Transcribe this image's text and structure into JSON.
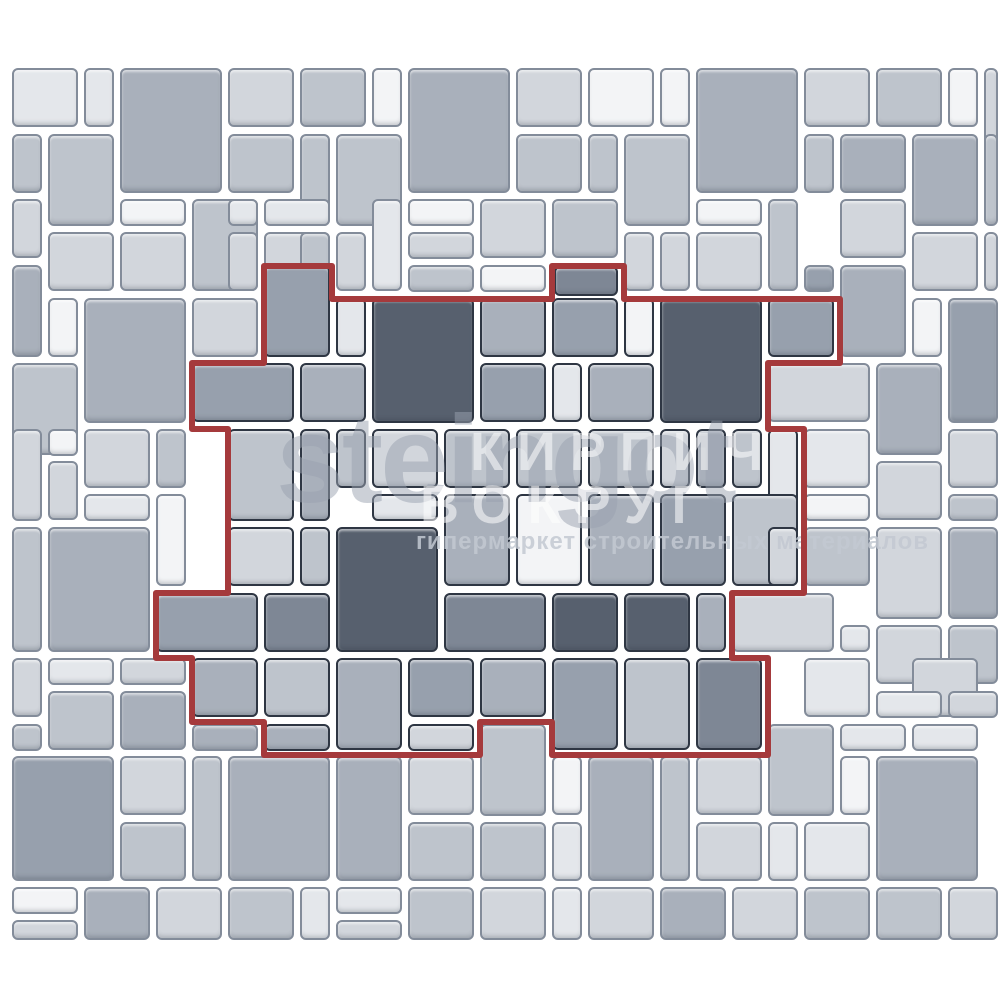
{
  "canvas": {
    "width": 1000,
    "height": 1000,
    "background": "#ffffff"
  },
  "palette": [
    "#f3f4f6",
    "#e4e7eb",
    "#d2d6dc",
    "#bec4cc",
    "#a9b0bb",
    "#97a0ad",
    "#7e8795",
    "#57606e"
  ],
  "strokes": {
    "outside_border": "#838c9a",
    "inside_border": "#2e3643",
    "grout": "#ffffff"
  },
  "outline": {
    "color": "#a53a3c",
    "width": 6,
    "path": "M 264 266 L 332 266 L 332 299 L 552 299 L 552 266 L 624 266 L 624 299 L 840 299 L 840 363 L 768 363 L 768 429 L 804 429 L 804 593 L 732 593 L 732 658 L 768 658 L 768 755 L 552 755 L 552 722 L 480 722 L 480 755 L 264 755 L 264 722 L 192 722 L 192 658 L 156 658 L 156 593 L 228 593 L 228 429 L 192 429 L 192 363 L 264 363 Z"
  },
  "watermark": {
    "brand": "steingot",
    "brand_color": "#9aa2b0",
    "tagline": "гипермаркет строительных материалов",
    "tagline_color": "#c3c9d2",
    "overlay_line1": "КИРПИЧ",
    "overlay_line2": "ВОКРУГ",
    "overlay_color": "#ffffff"
  },
  "tiles": [
    [
      12,
      68,
      66,
      59,
      1,
      0
    ],
    [
      84,
      68,
      30,
      59,
      1,
      0
    ],
    [
      120,
      68,
      102,
      125,
      4,
      0
    ],
    [
      228,
      68,
      66,
      59,
      2,
      0
    ],
    [
      300,
      68,
      66,
      59,
      3,
      0
    ],
    [
      372,
      68,
      30,
      59,
      0,
      0
    ],
    [
      408,
      68,
      102,
      125,
      4,
      0
    ],
    [
      516,
      68,
      66,
      59,
      2,
      0
    ],
    [
      588,
      68,
      66,
      59,
      0,
      0
    ],
    [
      660,
      68,
      30,
      59,
      0,
      0
    ],
    [
      696,
      68,
      102,
      125,
      4,
      0
    ],
    [
      804,
      68,
      66,
      59,
      2,
      0
    ],
    [
      876,
      68,
      66,
      59,
      3,
      0
    ],
    [
      948,
      68,
      30,
      59,
      0,
      0
    ],
    [
      984,
      68,
      14,
      125,
      2,
      0
    ],
    [
      12,
      134,
      30,
      59,
      3,
      0
    ],
    [
      48,
      134,
      66,
      92,
      3,
      0
    ],
    [
      228,
      134,
      66,
      59,
      3,
      0
    ],
    [
      300,
      134,
      30,
      92,
      3,
      0
    ],
    [
      336,
      134,
      66,
      92,
      3,
      0
    ],
    [
      516,
      134,
      66,
      59,
      3,
      0
    ],
    [
      588,
      134,
      30,
      59,
      3,
      0
    ],
    [
      624,
      134,
      66,
      92,
      3,
      0
    ],
    [
      804,
      134,
      30,
      59,
      3,
      0
    ],
    [
      840,
      134,
      66,
      59,
      4,
      0
    ],
    [
      912,
      134,
      66,
      92,
      4,
      0
    ],
    [
      984,
      134,
      14,
      92,
      3,
      0
    ],
    [
      12,
      199,
      30,
      59,
      2,
      0
    ],
    [
      120,
      199,
      66,
      27,
      0,
      0
    ],
    [
      192,
      199,
      66,
      92,
      3,
      0
    ],
    [
      228,
      199,
      30,
      27,
      1,
      0
    ],
    [
      264,
      199,
      66,
      27,
      1,
      0
    ],
    [
      372,
      199,
      30,
      92,
      1,
      0
    ],
    [
      408,
      199,
      66,
      27,
      0,
      0
    ],
    [
      480,
      199,
      66,
      59,
      2,
      0
    ],
    [
      552,
      199,
      66,
      59,
      3,
      0
    ],
    [
      696,
      199,
      66,
      27,
      0,
      0
    ],
    [
      768,
      199,
      30,
      92,
      3,
      0
    ],
    [
      840,
      199,
      66,
      59,
      2,
      0
    ],
    [
      48,
      232,
      66,
      59,
      2,
      0
    ],
    [
      120,
      232,
      66,
      59,
      2,
      0
    ],
    [
      228,
      232,
      30,
      59,
      2,
      0
    ],
    [
      264,
      232,
      66,
      59,
      2,
      0
    ],
    [
      300,
      232,
      30,
      59,
      3,
      0
    ],
    [
      336,
      232,
      30,
      59,
      2,
      0
    ],
    [
      408,
      232,
      66,
      27,
      2,
      0
    ],
    [
      624,
      232,
      30,
      59,
      2,
      0
    ],
    [
      660,
      232,
      30,
      59,
      2,
      0
    ],
    [
      696,
      232,
      66,
      59,
      2,
      0
    ],
    [
      912,
      232,
      66,
      59,
      2,
      0
    ],
    [
      984,
      232,
      14,
      59,
      2,
      0
    ],
    [
      12,
      265,
      30,
      92,
      4,
      0
    ],
    [
      408,
      265,
      66,
      27,
      3,
      0
    ],
    [
      480,
      265,
      66,
      27,
      0,
      0
    ],
    [
      804,
      265,
      30,
      27,
      5,
      0
    ],
    [
      840,
      265,
      66,
      92,
      4,
      0
    ],
    [
      48,
      298,
      30,
      59,
      0,
      0
    ],
    [
      84,
      298,
      102,
      125,
      4,
      0
    ],
    [
      192,
      298,
      66,
      59,
      2,
      0
    ],
    [
      912,
      298,
      30,
      59,
      0,
      0
    ],
    [
      948,
      298,
      50,
      125,
      5,
      0
    ],
    [
      12,
      363,
      66,
      92,
      3,
      0
    ],
    [
      768,
      363,
      102,
      59,
      2,
      0
    ],
    [
      876,
      363,
      66,
      92,
      4,
      0
    ],
    [
      12,
      429,
      30,
      92,
      2,
      0
    ],
    [
      48,
      429,
      30,
      27,
      0,
      0
    ],
    [
      84,
      429,
      66,
      59,
      2,
      0
    ],
    [
      156,
      429,
      30,
      59,
      3,
      0
    ],
    [
      48,
      461,
      30,
      59,
      2,
      0
    ],
    [
      804,
      429,
      66,
      59,
      1,
      0
    ],
    [
      876,
      461,
      66,
      59,
      2,
      0
    ],
    [
      948,
      429,
      50,
      59,
      2,
      0
    ],
    [
      84,
      494,
      66,
      27,
      1,
      0
    ],
    [
      156,
      494,
      30,
      92,
      0,
      0
    ],
    [
      804,
      494,
      66,
      27,
      0,
      0
    ],
    [
      948,
      494,
      50,
      27,
      3,
      0
    ],
    [
      12,
      527,
      30,
      125,
      3,
      0
    ],
    [
      48,
      527,
      102,
      125,
      4,
      0
    ],
    [
      804,
      527,
      66,
      59,
      3,
      0
    ],
    [
      876,
      527,
      66,
      92,
      2,
      0
    ],
    [
      948,
      527,
      50,
      92,
      4,
      0
    ],
    [
      732,
      593,
      102,
      59,
      2,
      0
    ],
    [
      840,
      625,
      30,
      27,
      1,
      0
    ],
    [
      876,
      625,
      66,
      59,
      2,
      0
    ],
    [
      948,
      625,
      50,
      59,
      3,
      0
    ],
    [
      12,
      658,
      30,
      59,
      2,
      0
    ],
    [
      48,
      658,
      66,
      27,
      1,
      0
    ],
    [
      120,
      658,
      66,
      27,
      2,
      0
    ],
    [
      804,
      658,
      66,
      59,
      1,
      0
    ],
    [
      912,
      658,
      66,
      59,
      2,
      0
    ],
    [
      48,
      691,
      66,
      59,
      3,
      0
    ],
    [
      120,
      691,
      66,
      59,
      4,
      0
    ],
    [
      876,
      691,
      66,
      27,
      1,
      0
    ],
    [
      948,
      691,
      50,
      27,
      2,
      0
    ],
    [
      12,
      724,
      30,
      27,
      3,
      0
    ],
    [
      192,
      724,
      66,
      27,
      4,
      0
    ],
    [
      804,
      724,
      30,
      27,
      2,
      0
    ],
    [
      840,
      724,
      66,
      27,
      1,
      0
    ],
    [
      912,
      724,
      66,
      27,
      1,
      0
    ],
    [
      768,
      724,
      66,
      92,
      3,
      0
    ],
    [
      480,
      724,
      66,
      92,
      3,
      0
    ],
    [
      12,
      756,
      102,
      125,
      5,
      0
    ],
    [
      120,
      756,
      66,
      59,
      2,
      0
    ],
    [
      192,
      756,
      30,
      125,
      3,
      0
    ],
    [
      228,
      756,
      102,
      125,
      4,
      0
    ],
    [
      336,
      756,
      66,
      125,
      4,
      0
    ],
    [
      408,
      756,
      66,
      59,
      2,
      0
    ],
    [
      552,
      756,
      30,
      59,
      0,
      0
    ],
    [
      588,
      756,
      66,
      125,
      4,
      0
    ],
    [
      660,
      756,
      30,
      125,
      3,
      0
    ],
    [
      696,
      756,
      66,
      59,
      2,
      0
    ],
    [
      840,
      756,
      30,
      59,
      0,
      0
    ],
    [
      876,
      756,
      102,
      125,
      4,
      0
    ],
    [
      120,
      822,
      66,
      59,
      3,
      0
    ],
    [
      408,
      822,
      66,
      59,
      3,
      0
    ],
    [
      480,
      822,
      66,
      59,
      3,
      0
    ],
    [
      552,
      822,
      30,
      59,
      1,
      0
    ],
    [
      696,
      822,
      66,
      59,
      2,
      0
    ],
    [
      768,
      822,
      30,
      59,
      1,
      0
    ],
    [
      804,
      822,
      66,
      59,
      1,
      0
    ],
    [
      12,
      887,
      66,
      27,
      0,
      0
    ],
    [
      12,
      920,
      66,
      20,
      2,
      0
    ],
    [
      84,
      887,
      66,
      53,
      4,
      0
    ],
    [
      156,
      887,
      66,
      53,
      2,
      0
    ],
    [
      228,
      887,
      66,
      53,
      3,
      0
    ],
    [
      300,
      887,
      30,
      53,
      1,
      0
    ],
    [
      336,
      887,
      66,
      27,
      1,
      0
    ],
    [
      336,
      920,
      66,
      20,
      2,
      0
    ],
    [
      408,
      887,
      66,
      53,
      3,
      0
    ],
    [
      480,
      887,
      66,
      53,
      2,
      0
    ],
    [
      552,
      887,
      30,
      53,
      1,
      0
    ],
    [
      588,
      887,
      66,
      53,
      2,
      0
    ],
    [
      660,
      887,
      66,
      53,
      4,
      0
    ],
    [
      732,
      887,
      66,
      53,
      2,
      0
    ],
    [
      804,
      887,
      66,
      53,
      3,
      0
    ],
    [
      876,
      887,
      66,
      53,
      3,
      0
    ],
    [
      948,
      887,
      50,
      53,
      2,
      0
    ],
    [
      264,
      265,
      66,
      92,
      5,
      1
    ],
    [
      554,
      266,
      64,
      30,
      6,
      1
    ],
    [
      336,
      298,
      30,
      59,
      1,
      1
    ],
    [
      372,
      298,
      102,
      125,
      7,
      1
    ],
    [
      480,
      298,
      66,
      59,
      4,
      1
    ],
    [
      552,
      298,
      66,
      59,
      5,
      1
    ],
    [
      624,
      298,
      30,
      59,
      0,
      1
    ],
    [
      660,
      298,
      102,
      125,
      7,
      1
    ],
    [
      768,
      298,
      66,
      59,
      5,
      1
    ],
    [
      192,
      363,
      102,
      59,
      5,
      1
    ],
    [
      300,
      363,
      66,
      59,
      4,
      1
    ],
    [
      480,
      363,
      66,
      59,
      5,
      1
    ],
    [
      552,
      363,
      30,
      59,
      1,
      1
    ],
    [
      588,
      363,
      66,
      59,
      4,
      1
    ],
    [
      228,
      429,
      66,
      92,
      3,
      1
    ],
    [
      300,
      429,
      30,
      92,
      4,
      1
    ],
    [
      336,
      429,
      30,
      59,
      3,
      1
    ],
    [
      372,
      429,
      66,
      59,
      2,
      1
    ],
    [
      444,
      429,
      66,
      59,
      3,
      1
    ],
    [
      516,
      429,
      66,
      59,
      3,
      1
    ],
    [
      588,
      429,
      66,
      59,
      3,
      1
    ],
    [
      660,
      429,
      30,
      59,
      2,
      1
    ],
    [
      696,
      429,
      30,
      59,
      4,
      1
    ],
    [
      732,
      429,
      30,
      59,
      3,
      1
    ],
    [
      768,
      429,
      30,
      92,
      1,
      1
    ],
    [
      372,
      494,
      66,
      27,
      1,
      1
    ],
    [
      444,
      494,
      66,
      92,
      4,
      1
    ],
    [
      516,
      494,
      66,
      92,
      0,
      1
    ],
    [
      588,
      494,
      66,
      92,
      4,
      1
    ],
    [
      660,
      494,
      66,
      92,
      5,
      1
    ],
    [
      732,
      494,
      66,
      92,
      3,
      1
    ],
    [
      228,
      527,
      66,
      59,
      2,
      1
    ],
    [
      300,
      527,
      30,
      59,
      3,
      1
    ],
    [
      336,
      527,
      102,
      125,
      7,
      1
    ],
    [
      768,
      527,
      30,
      59,
      2,
      1
    ],
    [
      156,
      593,
      102,
      59,
      5,
      1
    ],
    [
      264,
      593,
      66,
      59,
      6,
      1
    ],
    [
      444,
      593,
      102,
      59,
      6,
      1
    ],
    [
      552,
      593,
      66,
      59,
      7,
      1
    ],
    [
      624,
      593,
      66,
      59,
      7,
      1
    ],
    [
      696,
      593,
      30,
      59,
      4,
      1
    ],
    [
      192,
      658,
      66,
      59,
      4,
      1
    ],
    [
      264,
      658,
      66,
      59,
      3,
      1
    ],
    [
      336,
      658,
      66,
      92,
      4,
      1
    ],
    [
      408,
      658,
      66,
      59,
      5,
      1
    ],
    [
      480,
      658,
      66,
      59,
      4,
      1
    ],
    [
      552,
      658,
      66,
      92,
      5,
      1
    ],
    [
      624,
      658,
      66,
      92,
      3,
      1
    ],
    [
      696,
      658,
      66,
      92,
      6,
      1
    ],
    [
      264,
      724,
      66,
      27,
      4,
      1
    ],
    [
      408,
      724,
      66,
      27,
      2,
      1
    ]
  ]
}
